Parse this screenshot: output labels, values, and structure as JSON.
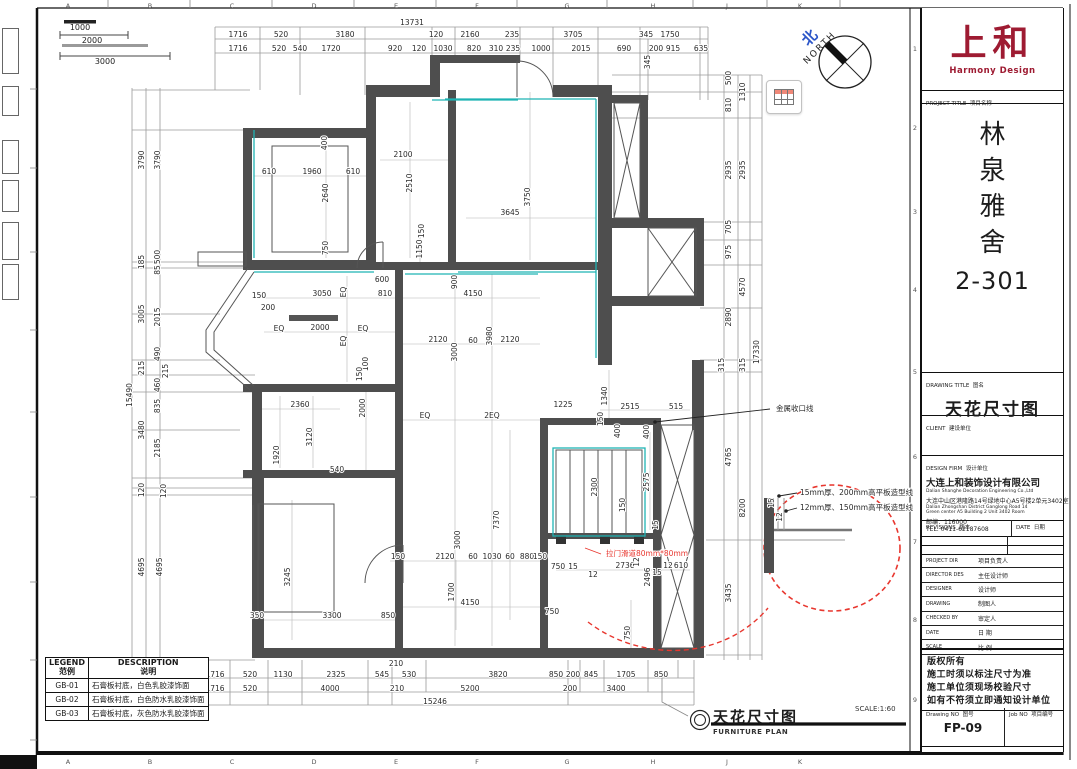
{
  "title_block": {
    "logo": {
      "cn": "上和",
      "en": "Harmony Design"
    },
    "project": {
      "label": "PROJECT TITLE",
      "label_cn": "项目名称",
      "name_chars": [
        "林",
        "泉",
        "雅",
        "舍"
      ],
      "unit": "2-301"
    },
    "drawing": {
      "label": "DRAWING TITLE",
      "label_cn": "图名",
      "title": "天花尺寸图"
    },
    "client": {
      "label": "CLIENT",
      "label_cn": "建设单位"
    },
    "design_firm": {
      "label": "DESIGN FIRM",
      "label_cn": "设计单位",
      "company_cn": "大连上和装饰设计有限公司",
      "company_en": "Dalian Shanghe Decoration Engineering Co.,Ltd",
      "address_cn": "大连中山区港隆路14号绿地中心A5号楼2单元3402室",
      "address_en1": "Dalian Zhongshan District Ganglong Road 14",
      "address_en2": "Green center A5 Building 2 Unit 3402 Room",
      "postal": "邮编：116000",
      "tel": "TEL: 0411-62187608"
    },
    "revisions": {
      "label": "REVISIONS",
      "label_cn": "版本",
      "date_label": "DATE",
      "date_cn": "日期"
    },
    "roles": [
      {
        "en": "PROJECT DIR",
        "cn": "项目负责人"
      },
      {
        "en": "DIRECTOR DES",
        "cn": "主任设计师"
      },
      {
        "en": "DESIGNER",
        "cn": "设计师"
      },
      {
        "en": "DRAWING",
        "cn": "制图人"
      },
      {
        "en": "CHECKED BY",
        "cn": "审定人"
      },
      {
        "en": "DATE",
        "cn": "日 期"
      },
      {
        "en": "SCALE",
        "cn": "比 例"
      }
    ],
    "notes": [
      "版权所有",
      "施工时须以标注尺寸为准",
      "施工单位须现场校验尺寸",
      "如有不符须立即通知设计单位"
    ],
    "drawing_no": {
      "label": "Drawing NO",
      "label_cn": "图号",
      "value": "FP-09"
    },
    "job_no": {
      "label": "Job NO",
      "label_cn": "项目编号"
    }
  },
  "legend": {
    "header": {
      "col1": "LEGEND",
      "col1_cn": "范例",
      "col2": "DESCRIPTION",
      "col2_cn": "说明"
    },
    "rows": [
      {
        "code": "GB-01",
        "desc": "石膏板衬底，白色乳胶漆饰面"
      },
      {
        "code": "GB-02",
        "desc": "石膏板衬底，白色防水乳胶漆饰面"
      },
      {
        "code": "GB-03",
        "desc": "石膏板衬底，灰色防水乳胶漆饰面"
      }
    ]
  },
  "plan_footer": {
    "title": "天花尺寸图",
    "subtitle": "FURNITURE PLAN",
    "scale": "SCALE:1:60"
  },
  "north": {
    "cn": "北",
    "en": "NORTH"
  },
  "scale_bars": {
    "b1": "1000",
    "b2": "2000",
    "b3": "3000"
  },
  "ruler": {
    "letters": [
      "A",
      "B",
      "C",
      "D",
      "E",
      "F",
      "G",
      "H",
      "J",
      "K"
    ],
    "numbers": [
      "1",
      "2",
      "3",
      "4",
      "5",
      "6",
      "7",
      "8",
      "9"
    ]
  },
  "colors": {
    "logo_red": "#9e1b32",
    "annotation_red": "#e8372f",
    "teal": "#1fb3b3",
    "wall": "#4e4e4e",
    "north_blue": "#2b55c8"
  },
  "dim_labels": [
    {
      "t": "13731",
      "x": 412,
      "y": 23
    },
    {
      "t": "1716",
      "x": 238,
      "y": 35
    },
    {
      "t": "520",
      "x": 281,
      "y": 35
    },
    {
      "t": "3180",
      "x": 345,
      "y": 35
    },
    {
      "t": "120",
      "x": 436,
      "y": 35
    },
    {
      "t": "2160",
      "x": 470,
      "y": 35
    },
    {
      "t": "235",
      "x": 512,
      "y": 35
    },
    {
      "t": "3705",
      "x": 573,
      "y": 35
    },
    {
      "t": "345",
      "x": 646,
      "y": 35
    },
    {
      "t": "1750",
      "x": 670,
      "y": 35
    },
    {
      "t": "1716",
      "x": 238,
      "y": 49
    },
    {
      "t": "520",
      "x": 279,
      "y": 49
    },
    {
      "t": "540",
      "x": 300,
      "y": 49
    },
    {
      "t": "1720",
      "x": 331,
      "y": 49
    },
    {
      "t": "920",
      "x": 395,
      "y": 49
    },
    {
      "t": "120",
      "x": 419,
      "y": 49
    },
    {
      "t": "1030",
      "x": 443,
      "y": 49
    },
    {
      "t": "820",
      "x": 474,
      "y": 49
    },
    {
      "t": "310",
      "x": 496,
      "y": 49
    },
    {
      "t": "235",
      "x": 513,
      "y": 49
    },
    {
      "t": "1000",
      "x": 541,
      "y": 49
    },
    {
      "t": "2015",
      "x": 581,
      "y": 49
    },
    {
      "t": "690",
      "x": 624,
      "y": 49
    },
    {
      "t": "200",
      "x": 656,
      "y": 49
    },
    {
      "t": "915",
      "x": 673,
      "y": 49
    },
    {
      "t": "635",
      "x": 701,
      "y": 49
    },
    {
      "t": "345",
      "x": 648,
      "y": 62,
      "r": 1
    },
    {
      "t": "15490",
      "x": 130,
      "y": 395,
      "r": 1
    },
    {
      "t": "3790",
      "x": 142,
      "y": 160,
      "r": 1
    },
    {
      "t": "185",
      "x": 142,
      "y": 262,
      "r": 1
    },
    {
      "t": "3005",
      "x": 142,
      "y": 314,
      "r": 1
    },
    {
      "t": "215",
      "x": 142,
      "y": 368,
      "r": 1
    },
    {
      "t": "3480",
      "x": 142,
      "y": 430,
      "r": 1
    },
    {
      "t": "120",
      "x": 142,
      "y": 490,
      "r": 1
    },
    {
      "t": "4695",
      "x": 142,
      "y": 567,
      "r": 1
    },
    {
      "t": "3790",
      "x": 158,
      "y": 160,
      "r": 1
    },
    {
      "t": "500",
      "x": 158,
      "y": 257,
      "r": 1
    },
    {
      "t": "85",
      "x": 158,
      "y": 270,
      "r": 1
    },
    {
      "t": "2015",
      "x": 158,
      "y": 317,
      "r": 1
    },
    {
      "t": "490",
      "x": 158,
      "y": 354,
      "r": 1
    },
    {
      "t": "215",
      "x": 166,
      "y": 371,
      "r": 1
    },
    {
      "t": "460",
      "x": 158,
      "y": 385,
      "r": 1
    },
    {
      "t": "835",
      "x": 158,
      "y": 406,
      "r": 1
    },
    {
      "t": "2185",
      "x": 158,
      "y": 448,
      "r": 1
    },
    {
      "t": "120",
      "x": 164,
      "y": 491,
      "r": 1
    },
    {
      "t": "4695",
      "x": 160,
      "y": 567,
      "r": 1
    },
    {
      "t": "500",
      "x": 729,
      "y": 78,
      "r": 1
    },
    {
      "t": "810",
      "x": 729,
      "y": 105,
      "r": 1
    },
    {
      "t": "2935",
      "x": 729,
      "y": 170,
      "r": 1
    },
    {
      "t": "705",
      "x": 729,
      "y": 227,
      "r": 1
    },
    {
      "t": "975",
      "x": 729,
      "y": 252,
      "r": 1
    },
    {
      "t": "2890",
      "x": 729,
      "y": 317,
      "r": 1
    },
    {
      "t": "315",
      "x": 722,
      "y": 365,
      "r": 1
    },
    {
      "t": "4765",
      "x": 729,
      "y": 457,
      "r": 1
    },
    {
      "t": "3435",
      "x": 729,
      "y": 593,
      "r": 1
    },
    {
      "t": "1310",
      "x": 743,
      "y": 92,
      "r": 1
    },
    {
      "t": "2935",
      "x": 743,
      "y": 170,
      "r": 1
    },
    {
      "t": "4570",
      "x": 743,
      "y": 287,
      "r": 1
    },
    {
      "t": "315",
      "x": 743,
      "y": 365,
      "r": 1
    },
    {
      "t": "8200",
      "x": 743,
      "y": 508,
      "r": 1
    },
    {
      "t": "17330",
      "x": 757,
      "y": 352,
      "r": 1
    },
    {
      "t": "1716",
      "x": 215,
      "y": 675
    },
    {
      "t": "520",
      "x": 250,
      "y": 675
    },
    {
      "t": "1130",
      "x": 283,
      "y": 675
    },
    {
      "t": "2325",
      "x": 336,
      "y": 675
    },
    {
      "t": "545",
      "x": 382,
      "y": 675
    },
    {
      "t": "530",
      "x": 409,
      "y": 675
    },
    {
      "t": "3820",
      "x": 498,
      "y": 675
    },
    {
      "t": "850",
      "x": 556,
      "y": 675
    },
    {
      "t": "200",
      "x": 573,
      "y": 675
    },
    {
      "t": "845",
      "x": 591,
      "y": 675
    },
    {
      "t": "1705",
      "x": 626,
      "y": 675
    },
    {
      "t": "850",
      "x": 661,
      "y": 675
    },
    {
      "t": "210",
      "x": 396,
      "y": 664
    },
    {
      "t": "1716",
      "x": 215,
      "y": 689
    },
    {
      "t": "520",
      "x": 250,
      "y": 689
    },
    {
      "t": "4000",
      "x": 330,
      "y": 689
    },
    {
      "t": "210",
      "x": 397,
      "y": 689
    },
    {
      "t": "5200",
      "x": 470,
      "y": 689
    },
    {
      "t": "200",
      "x": 570,
      "y": 689
    },
    {
      "t": "3400",
      "x": 616,
      "y": 689
    },
    {
      "t": "15246",
      "x": 435,
      "y": 702
    },
    {
      "t": "400",
      "x": 325,
      "y": 143,
      "r": 1
    },
    {
      "t": "610",
      "x": 269,
      "y": 172
    },
    {
      "t": "1960",
      "x": 312,
      "y": 172
    },
    {
      "t": "610",
      "x": 353,
      "y": 172
    },
    {
      "t": "2640",
      "x": 326,
      "y": 193,
      "r": 1
    },
    {
      "t": "750",
      "x": 326,
      "y": 248,
      "r": 1
    },
    {
      "t": "2100",
      "x": 403,
      "y": 155
    },
    {
      "t": "2510",
      "x": 410,
      "y": 183,
      "r": 1
    },
    {
      "t": "150",
      "x": 422,
      "y": 231,
      "r": 1
    },
    {
      "t": "1150",
      "x": 420,
      "y": 249,
      "r": 1
    },
    {
      "t": "3645",
      "x": 510,
      "y": 213
    },
    {
      "t": "3750",
      "x": 528,
      "y": 197,
      "r": 1
    },
    {
      "t": "600",
      "x": 382,
      "y": 280
    },
    {
      "t": "810",
      "x": 385,
      "y": 294
    },
    {
      "t": "3050",
      "x": 322,
      "y": 294
    },
    {
      "t": "EQ",
      "x": 344,
      "y": 292,
      "r": 1
    },
    {
      "t": "150",
      "x": 259,
      "y": 296
    },
    {
      "t": "200",
      "x": 268,
      "y": 308
    },
    {
      "t": "EQ",
      "x": 279,
      "y": 329
    },
    {
      "t": "2000",
      "x": 320,
      "y": 328
    },
    {
      "t": "EQ",
      "x": 363,
      "y": 329
    },
    {
      "t": "EQ",
      "x": 344,
      "y": 341,
      "r": 1
    },
    {
      "t": "900",
      "x": 455,
      "y": 282,
      "r": 1
    },
    {
      "t": "4150",
      "x": 473,
      "y": 294
    },
    {
      "t": "2120",
      "x": 438,
      "y": 340
    },
    {
      "t": "3000",
      "x": 455,
      "y": 352,
      "r": 1
    },
    {
      "t": "60",
      "x": 473,
      "y": 341
    },
    {
      "t": "3980",
      "x": 490,
      "y": 336,
      "r": 1
    },
    {
      "t": "2120",
      "x": 510,
      "y": 340
    },
    {
      "t": "100",
      "x": 366,
      "y": 364,
      "r": 1
    },
    {
      "t": "150",
      "x": 360,
      "y": 374,
      "r": 1
    },
    {
      "t": "2360",
      "x": 300,
      "y": 405
    },
    {
      "t": "1920",
      "x": 277,
      "y": 455,
      "r": 1
    },
    {
      "t": "3120",
      "x": 310,
      "y": 437,
      "r": 1
    },
    {
      "t": "540",
      "x": 337,
      "y": 470
    },
    {
      "t": "2000",
      "x": 363,
      "y": 408,
      "r": 1
    },
    {
      "t": "EQ",
      "x": 425,
      "y": 416
    },
    {
      "t": "2EQ",
      "x": 492,
      "y": 416
    },
    {
      "t": "1225",
      "x": 563,
      "y": 405
    },
    {
      "t": "1340",
      "x": 605,
      "y": 396,
      "r": 1
    },
    {
      "t": "2515",
      "x": 630,
      "y": 407
    },
    {
      "t": "515",
      "x": 676,
      "y": 407
    },
    {
      "t": "400",
      "x": 618,
      "y": 431,
      "r": 1
    },
    {
      "t": "400",
      "x": 647,
      "y": 432,
      "r": 1
    },
    {
      "t": "150",
      "x": 601,
      "y": 419,
      "r": 1
    },
    {
      "t": "2300",
      "x": 595,
      "y": 487,
      "r": 1
    },
    {
      "t": "2575",
      "x": 647,
      "y": 482,
      "r": 1
    },
    {
      "t": "150",
      "x": 623,
      "y": 505,
      "r": 1
    },
    {
      "t": "15",
      "x": 656,
      "y": 525,
      "r": 1
    },
    {
      "t": "7370",
      "x": 497,
      "y": 520,
      "r": 1
    },
    {
      "t": "150",
      "x": 398,
      "y": 557
    },
    {
      "t": "2120",
      "x": 445,
      "y": 557
    },
    {
      "t": "60",
      "x": 473,
      "y": 557
    },
    {
      "t": "1030",
      "x": 492,
      "y": 557
    },
    {
      "t": "60",
      "x": 510,
      "y": 557
    },
    {
      "t": "880",
      "x": 527,
      "y": 557
    },
    {
      "t": "150",
      "x": 540,
      "y": 557
    },
    {
      "t": "3000",
      "x": 458,
      "y": 540,
      "r": 1
    },
    {
      "t": "3245",
      "x": 288,
      "y": 577,
      "r": 1
    },
    {
      "t": "350",
      "x": 257,
      "y": 616
    },
    {
      "t": "3300",
      "x": 332,
      "y": 616
    },
    {
      "t": "850",
      "x": 388,
      "y": 616
    },
    {
      "t": "1700",
      "x": 452,
      "y": 592,
      "r": 1
    },
    {
      "t": "4150",
      "x": 470,
      "y": 603
    },
    {
      "t": "750",
      "x": 558,
      "y": 567
    },
    {
      "t": "15",
      "x": 573,
      "y": 567
    },
    {
      "t": "2736",
      "x": 625,
      "y": 566
    },
    {
      "t": "12",
      "x": 637,
      "y": 562,
      "r": 1
    },
    {
      "t": "12",
      "x": 593,
      "y": 575
    },
    {
      "t": "2496",
      "x": 648,
      "y": 577,
      "r": 1
    },
    {
      "t": "15",
      "x": 657,
      "y": 573
    },
    {
      "t": "12",
      "x": 668,
      "y": 566
    },
    {
      "t": "610",
      "x": 681,
      "y": 566
    },
    {
      "t": "750",
      "x": 552,
      "y": 612
    },
    {
      "t": "750",
      "x": 628,
      "y": 633,
      "r": 1
    },
    {
      "t": "15",
      "x": 772,
      "y": 503,
      "r": 1
    },
    {
      "t": "12",
      "x": 780,
      "y": 517,
      "r": 1
    },
    {
      "t": "金属收口线",
      "x": 776,
      "y": 409,
      "a": 1,
      "s": 8
    },
    {
      "t": "15mm厚、200mm高平板造型线",
      "x": 800,
      "y": 493,
      "a": 1,
      "s": 8
    },
    {
      "t": "12mm厚、150mm高平板造型线",
      "x": 800,
      "y": 508,
      "a": 1,
      "s": 8
    },
    {
      "t": "拉门滑道80mm*80mm",
      "x": 606,
      "y": 554,
      "a": 1,
      "c": 1,
      "s": 8
    }
  ]
}
